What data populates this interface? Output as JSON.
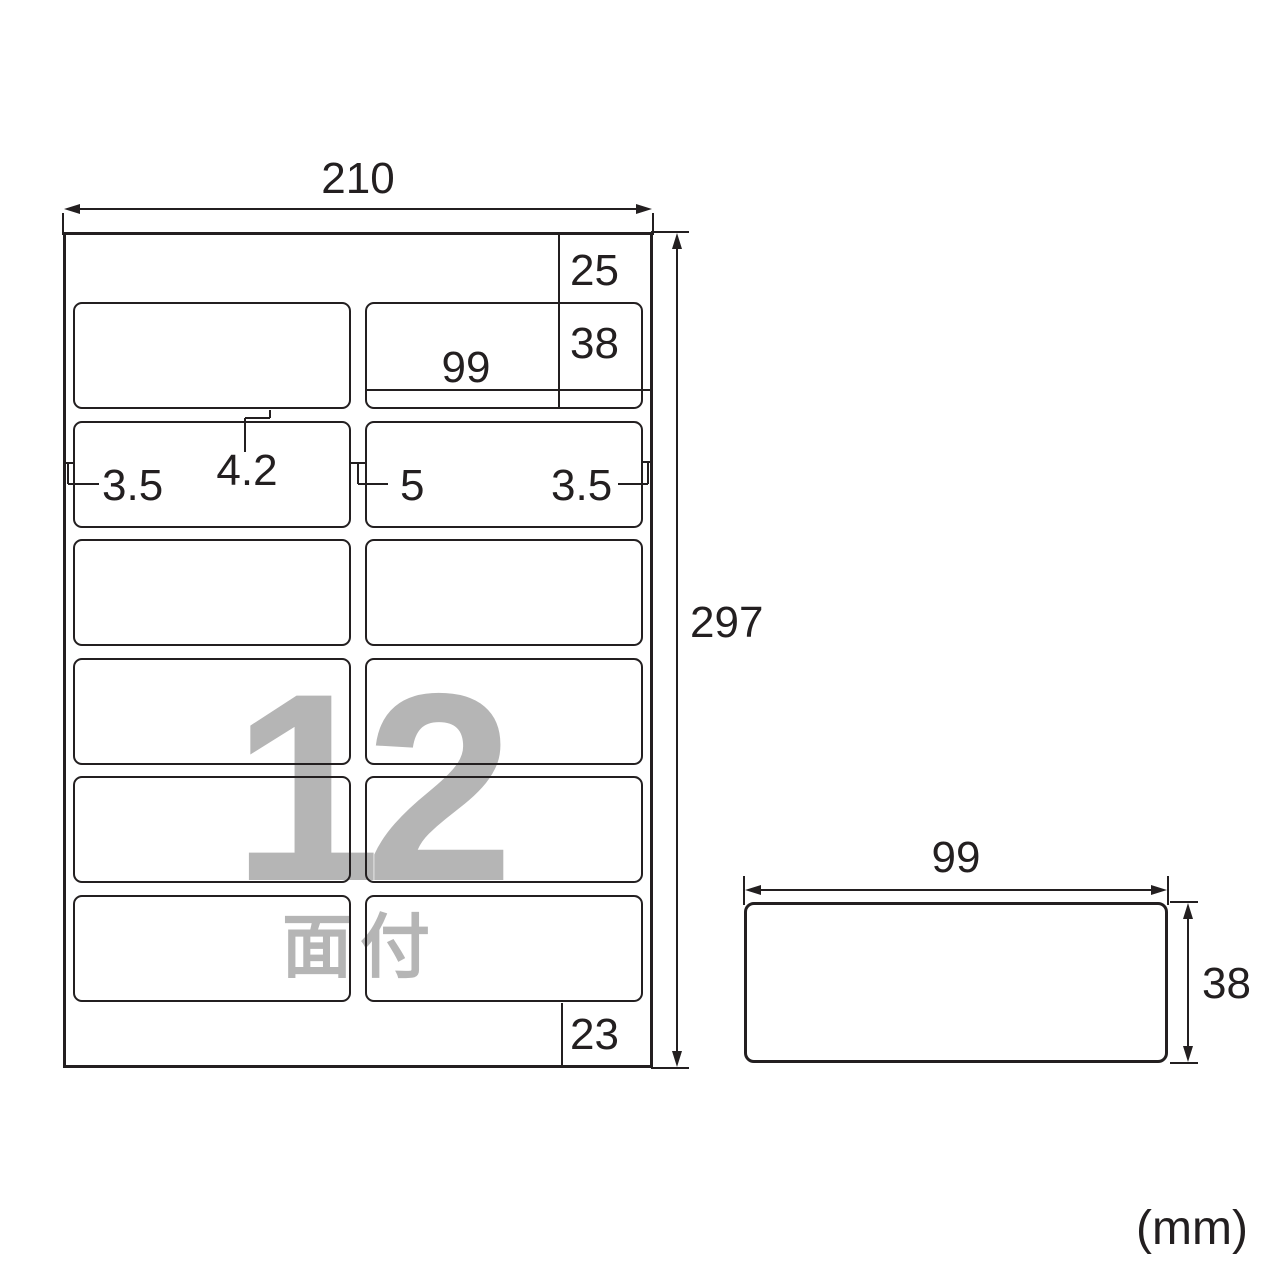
{
  "unit_note": "(mm)",
  "sheet": {
    "width_mm": "210",
    "height_mm": "297",
    "top_margin_mm": "25",
    "label_height_mm": "38",
    "label_width_mm": "99",
    "left_margin_mm": "3.5",
    "row_gap_mm": "4.2",
    "col_gap_mm": "5",
    "right_margin_mm": "3.5",
    "bottom_margin_mm": "23",
    "grid": {
      "rows": 6,
      "cols": 2
    },
    "count_overlay": {
      "number": "12",
      "suffix": "面付"
    }
  },
  "label_detail": {
    "width_mm": "99",
    "height_mm": "38"
  },
  "colors": {
    "line": "#231f20",
    "overlay_gray": "#b5b5b5",
    "background": "#ffffff"
  }
}
